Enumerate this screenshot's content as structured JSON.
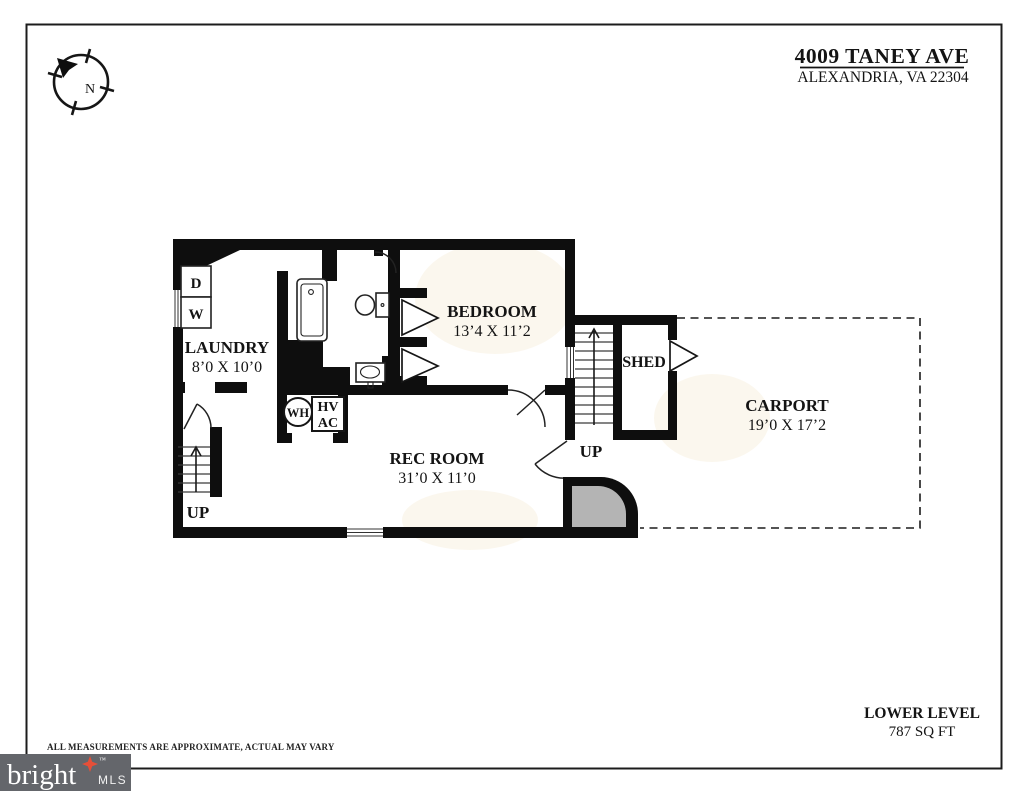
{
  "header": {
    "address_line1": "4009 TANEY AVE",
    "address_line2": "ALEXANDRIA, VA 22304"
  },
  "compass": {
    "north_label": "N"
  },
  "floorplan": {
    "rooms": {
      "laundry": {
        "name": "LAUNDRY",
        "dims": "8’0 X 10’0"
      },
      "bedroom": {
        "name": "BEDROOM",
        "dims": "13’4 X 11’2"
      },
      "rec_room": {
        "name": "REC ROOM",
        "dims": "31’0 X 11’0"
      },
      "shed": {
        "name": "SHED"
      },
      "carport": {
        "name": "CARPORT",
        "dims": "19’0 X 17’2"
      }
    },
    "labels": {
      "dryer": "D",
      "washer": "W",
      "water_heater": "WH",
      "hvac_top": "HV",
      "hvac_bottom": "AC",
      "stairs_left_up": "UP",
      "stairs_right_up": "UP"
    }
  },
  "footer": {
    "level_name": "LOWER LEVEL",
    "area": "787 SQ FT",
    "disclaimer": "ALL MEASUREMENTS ARE APPROXIMATE, ACTUAL MAY VARY"
  },
  "logo": {
    "brand": "bright",
    "tm": "™",
    "suffix": "MLS"
  },
  "colors": {
    "wall": "#0e0e0e",
    "stoop": "#b4b4b4",
    "logobg": "#64666b",
    "accent": "#e64f38",
    "line": "#1c1c1c"
  }
}
